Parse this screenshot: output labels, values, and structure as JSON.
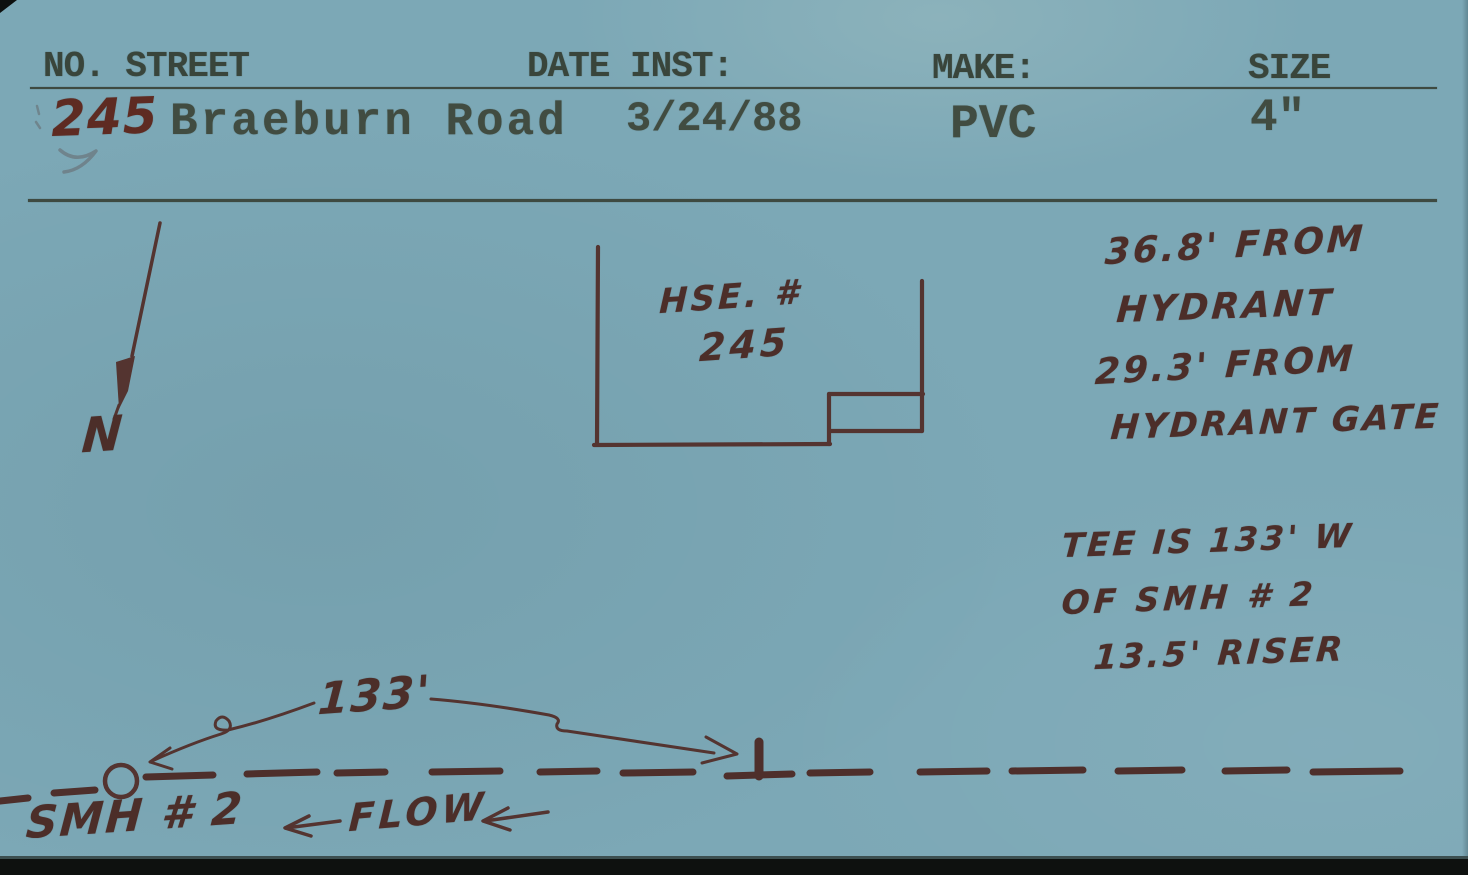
{
  "colors": {
    "card_background": "#7ca8b6",
    "typed_ink": "#3d483d",
    "handwritten_ink": "#4c2e29",
    "house_number_ink": "#5e2b22"
  },
  "header": {
    "no_street_label": "NO. STREET",
    "date_inst_label": "DATE INST:",
    "make_label": "MAKE:",
    "size_label": "SIZE",
    "house_number": "245",
    "street_name": "Braeburn Road",
    "date_installed": "3/24/88",
    "make": "PVC",
    "size": "4\""
  },
  "sketch": {
    "north_label": "N",
    "house": {
      "label_line1": "HSE. #",
      "label_line2": "245"
    },
    "hydrant_notes": [
      "36.8' FROM",
      "HYDRANT",
      "29.3' FROM",
      "HYDRANT GATE"
    ],
    "tee_notes": [
      "TEE IS 133' W",
      "OF SMH # 2",
      "13.5' RISER"
    ],
    "distance_label": "133'",
    "manhole_label": "SMH # 2",
    "flow_label": "FLOW"
  }
}
